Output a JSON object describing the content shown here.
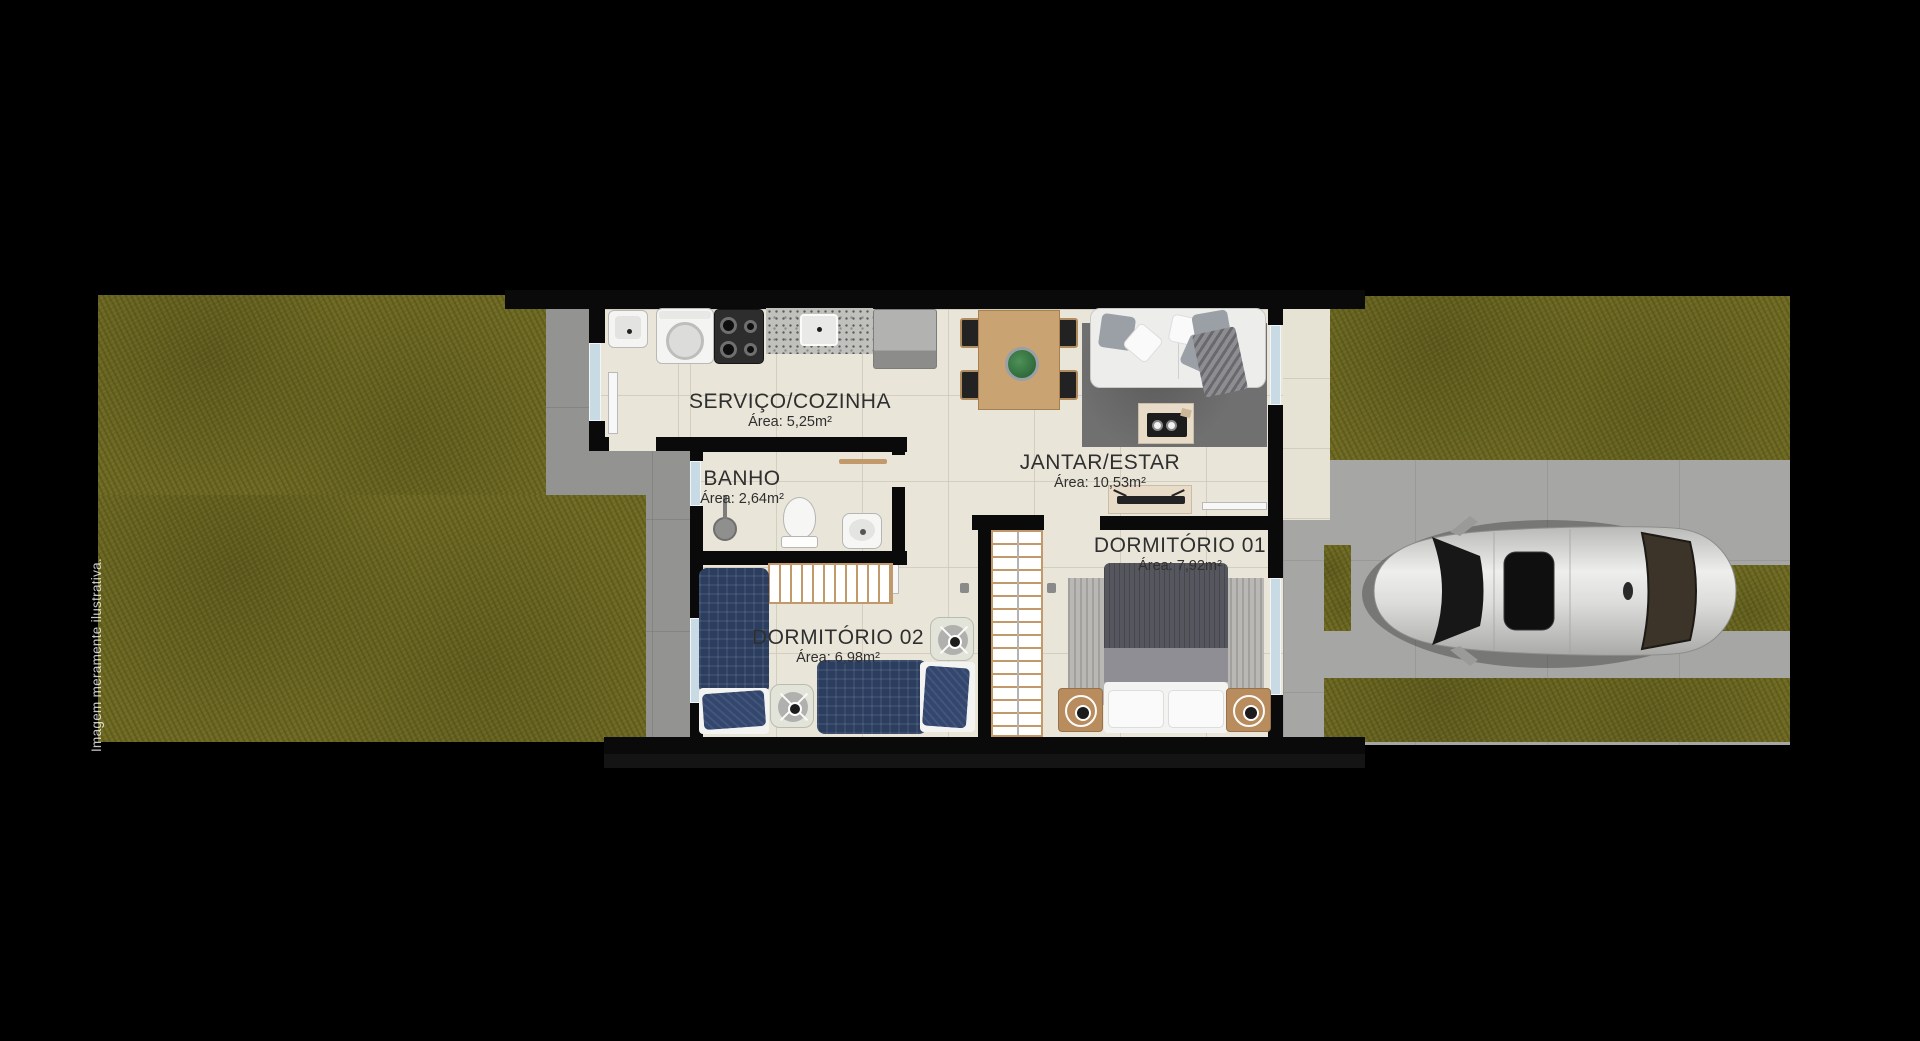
{
  "watermark": "Imagem meramente ilustrativa.",
  "rooms": [
    {
      "name": "SERVIÇO/COZINHA",
      "area": "Área: 5,25m²"
    },
    {
      "name": "BANHO",
      "area": "Área: 2,64m²"
    },
    {
      "name": "JANTAR/ESTAR",
      "area": "Área: 10,53m²"
    },
    {
      "name": "DORMITÓRIO 01",
      "area": "Área: 7,92m²"
    },
    {
      "name": "DORMITÓRIO 02",
      "area": "Área: 6,98m²"
    }
  ],
  "colors": {
    "background": "#000000",
    "grass": "#6e6a23",
    "concrete": "#939391",
    "driveway": "#a6a6a4",
    "interior_floor": "#e9e5d9",
    "wall": "#0a0a0a",
    "window": "#c8dbe4",
    "wood": "#c2996a",
    "bed_blue": "#2c3e5f",
    "label_text": "#2f2f2f"
  }
}
